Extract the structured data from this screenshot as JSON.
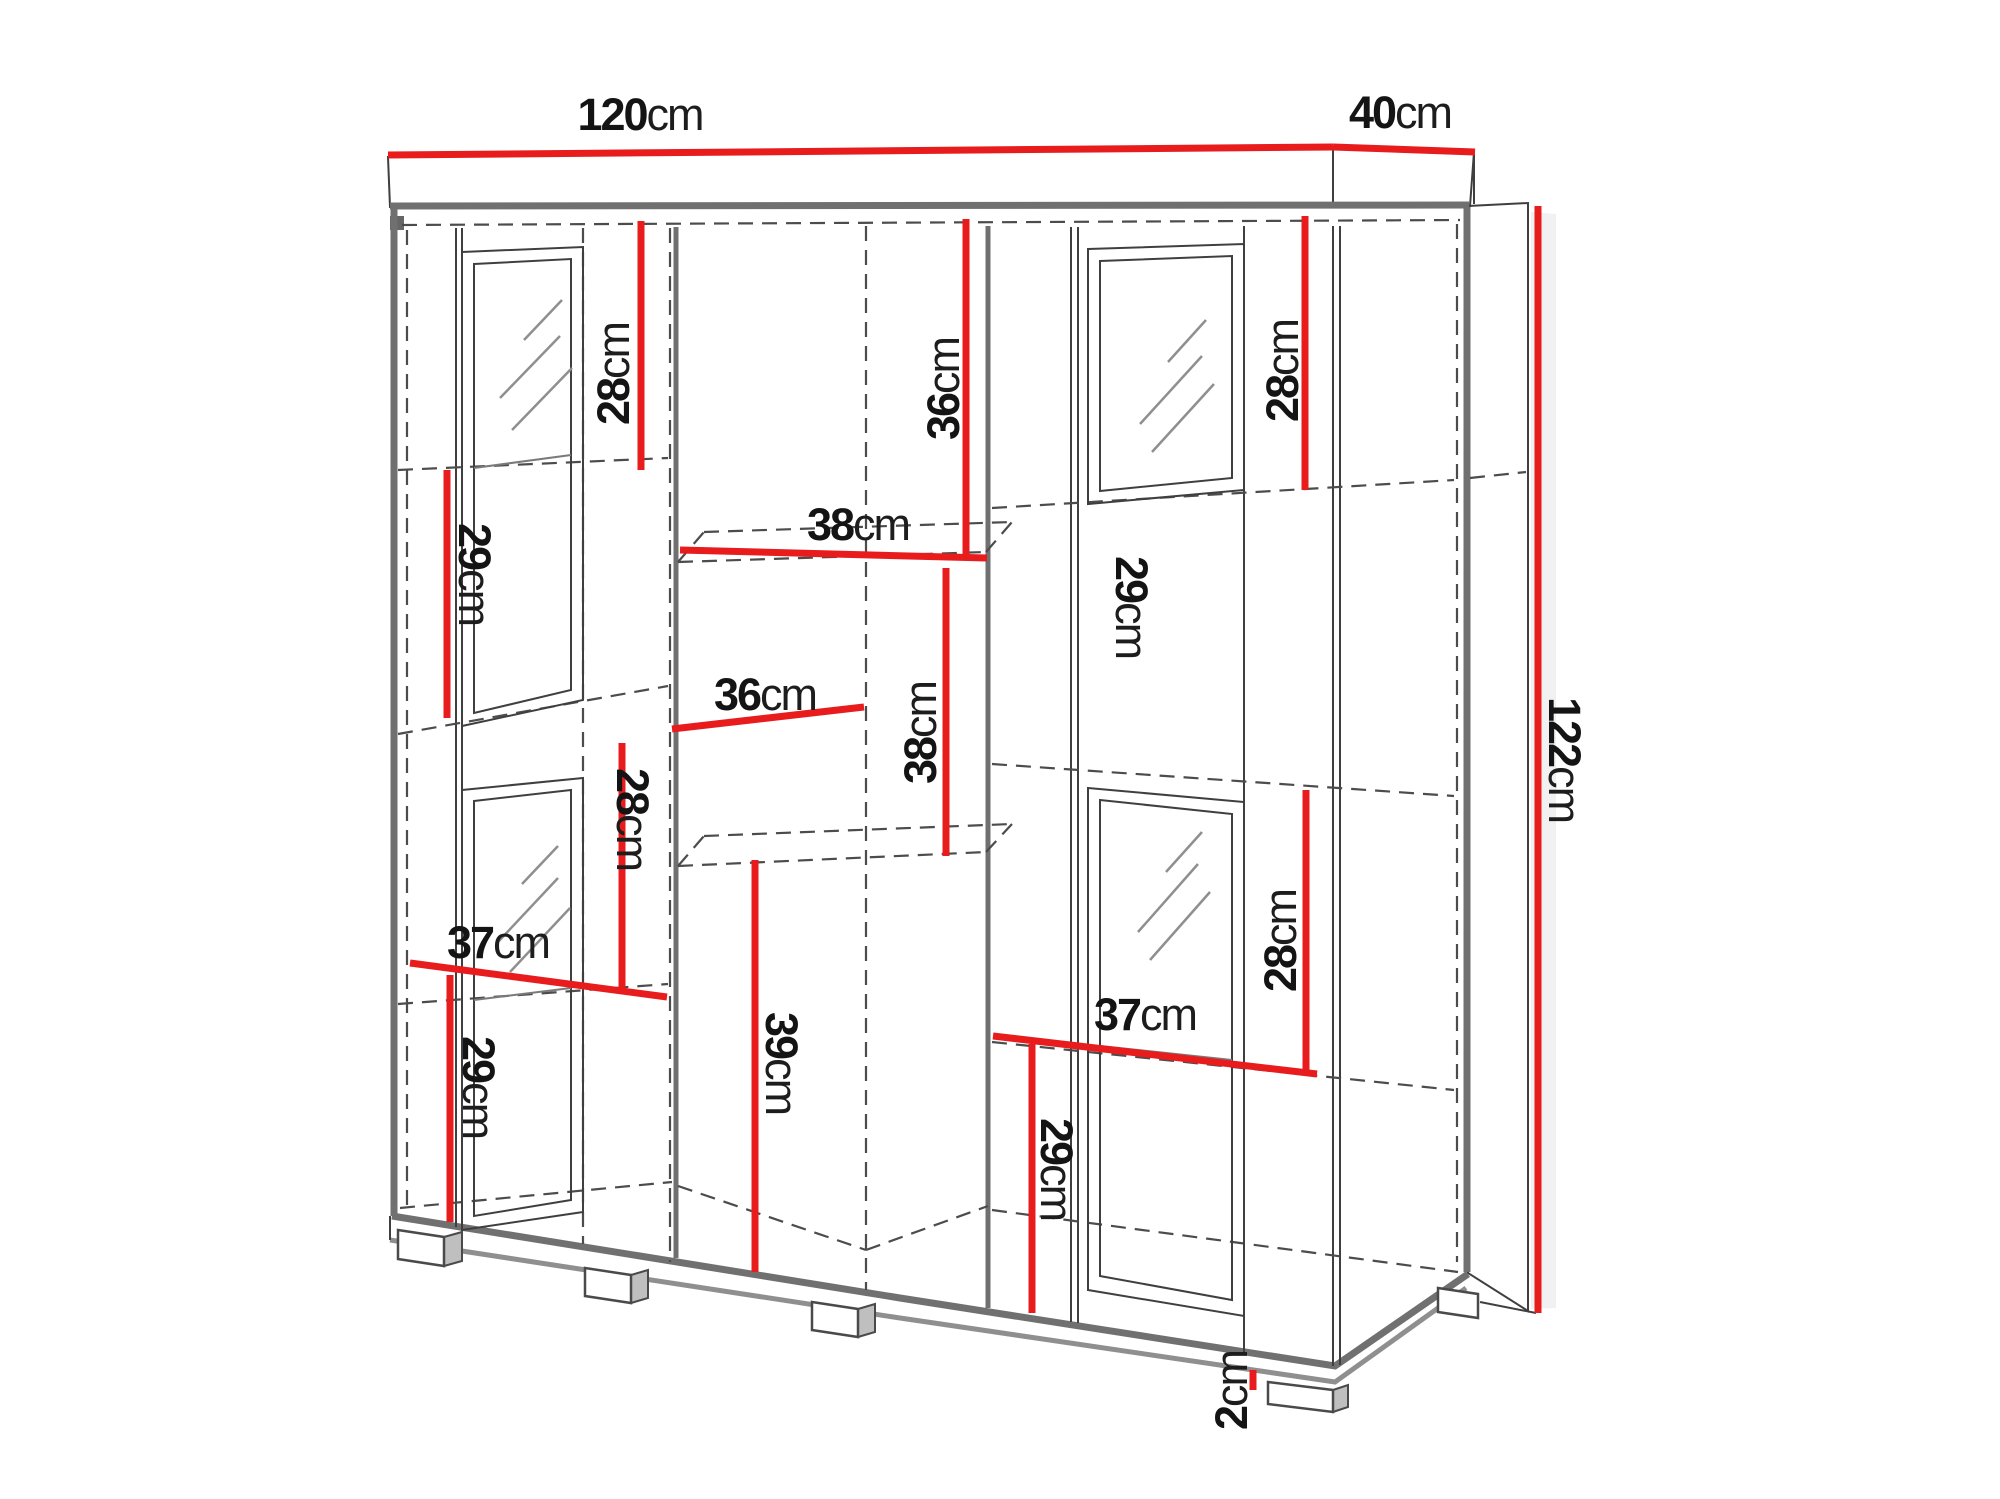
{
  "diagram": {
    "type": "furniture-dimension-drawing",
    "subject": "display cabinet with glass doors, interior shelves and feet",
    "unit": "cm",
    "overall": {
      "width_cm": 120,
      "depth_cm": 40,
      "height_cm": 122,
      "feet_height_cm": 2
    },
    "colors": {
      "dimension_red": "#e81c1c",
      "line_dark": "#3f3f3f",
      "line_gray": "#707070",
      "text": "#141414",
      "background": "#ffffff"
    },
    "labels": [
      {
        "name": "overall-width",
        "num": "120",
        "unit": "cm"
      },
      {
        "name": "overall-depth",
        "num": "40",
        "unit": "cm"
      },
      {
        "name": "overall-height",
        "num": "122",
        "unit": "cm"
      },
      {
        "name": "top-left-section",
        "num": "28",
        "unit": "cm"
      },
      {
        "name": "top-center-section",
        "num": "36",
        "unit": "cm"
      },
      {
        "name": "top-right-section",
        "num": "28",
        "unit": "cm"
      },
      {
        "name": "left-second-section",
        "num": "29",
        "unit": "cm"
      },
      {
        "name": "center-width",
        "num": "38",
        "unit": "cm"
      },
      {
        "name": "center-depth",
        "num": "36",
        "unit": "cm"
      },
      {
        "name": "center-second-height",
        "num": "38",
        "unit": "cm"
      },
      {
        "name": "left-third-section",
        "num": "28",
        "unit": "cm"
      },
      {
        "name": "left-lower-width",
        "num": "37",
        "unit": "cm"
      },
      {
        "name": "left-bottom-section",
        "num": "29",
        "unit": "cm"
      },
      {
        "name": "center-bottom-height",
        "num": "39",
        "unit": "cm"
      },
      {
        "name": "right-second-section",
        "num": "29",
        "unit": "cm"
      },
      {
        "name": "right-lower-width",
        "num": "37",
        "unit": "cm"
      },
      {
        "name": "right-bottom-section",
        "num": "29",
        "unit": "cm"
      },
      {
        "name": "right-third-section",
        "num": "28",
        "unit": "cm"
      },
      {
        "name": "feet-height",
        "num": "2",
        "unit": "cm"
      }
    ]
  }
}
